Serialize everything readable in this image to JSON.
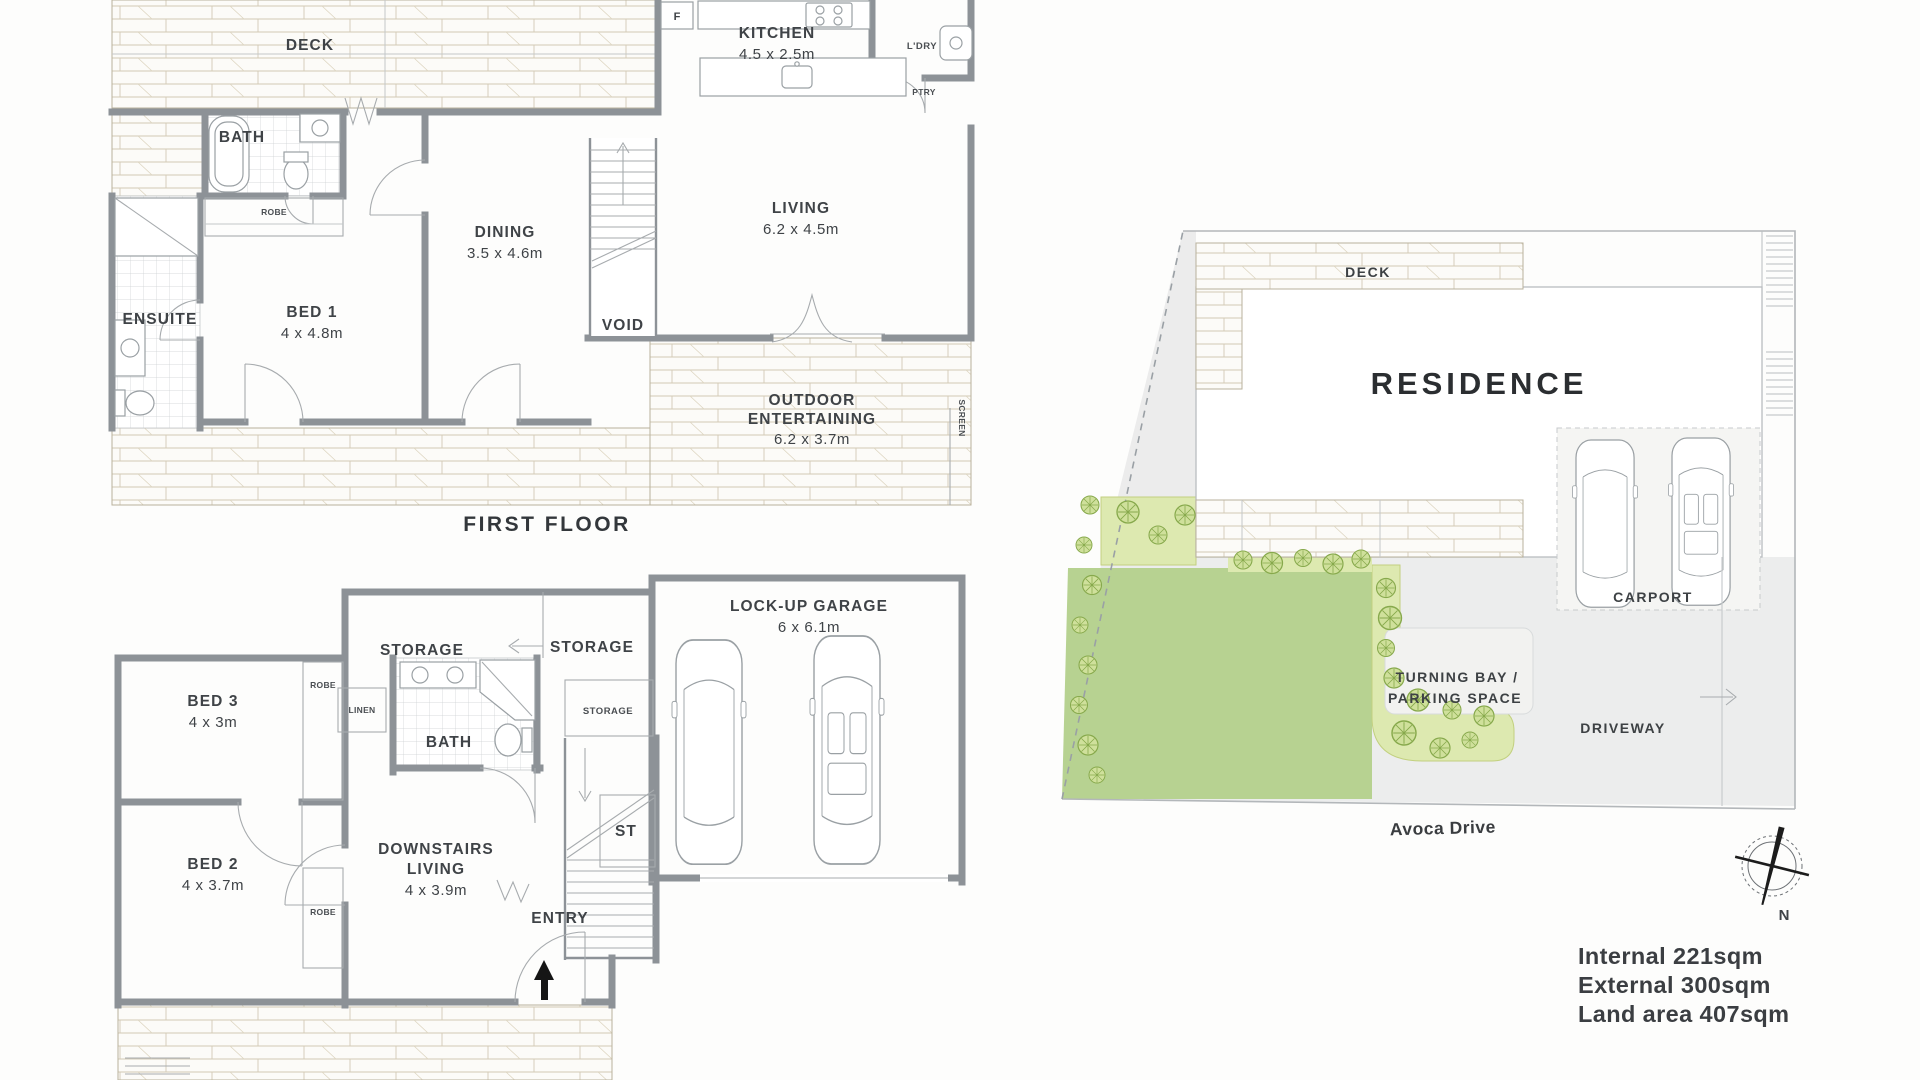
{
  "document_type": "floor-plan",
  "colors": {
    "wall_gray": "#8d9297",
    "lawn_green": "#b7d291",
    "garden_bed_green": "#dde9b0",
    "plant_green": "#87a94c",
    "driveway_gray": "#eceded",
    "text_dark": "#3f4347",
    "wood_hatch": "#cfc7b2"
  },
  "first_floor": {
    "section_label": "FIRST FLOOR",
    "deck": "DECK",
    "fridge": "F",
    "kitchen": {
      "label": "KITCHEN",
      "dims": "4.5 x 2.5m"
    },
    "ldry": "L'DRY",
    "ptry": "PTRY",
    "bath": "BATH",
    "robe": "ROBE",
    "ensuite": "ENSUITE",
    "bed1": {
      "label": "BED 1",
      "dims": "4 x 4.8m"
    },
    "dining": {
      "label": "DINING",
      "dims": "3.5 x 4.6m"
    },
    "void": "VOID",
    "living": {
      "label": "LIVING",
      "dims": "6.2 x 4.5m"
    },
    "outdoor": {
      "label1": "OUTDOOR",
      "label2": "ENTERTAINING",
      "dims": "6.2 x 3.7m"
    },
    "screen": "SCREEN"
  },
  "ground_floor": {
    "storage_left": "STORAGE",
    "storage_mid": "STORAGE",
    "storage_under_stairs": "STORAGE",
    "garage": {
      "label": "LOCK-UP GARAGE",
      "dims": "6 x 6.1m"
    },
    "bed3": {
      "label": "BED 3",
      "dims": "4 x 3m"
    },
    "robe_bed3": "ROBE",
    "linen": "LINEN",
    "bath": "BATH",
    "st": "ST",
    "bed2": {
      "label": "BED 2",
      "dims": "4 x 3.7m"
    },
    "robe_bed2": "ROBE",
    "downstairs_living": {
      "label1": "DOWNSTAIRS",
      "label2": "LIVING",
      "dims": "4 x 3.9m"
    },
    "entry": "ENTRY"
  },
  "site_plan": {
    "deck": "DECK",
    "residence": "RESIDENCE",
    "carport": "CARPORT",
    "turning_bay_line1": "TURNING BAY /",
    "turning_bay_line2": "PARKING SPACE",
    "driveway": "DRIVEWAY",
    "street": "Avoca Drive",
    "compass_north": "N"
  },
  "areas": {
    "internal": "Internal 221sqm",
    "external": "External 300sqm",
    "land": "Land area 407sqm"
  }
}
